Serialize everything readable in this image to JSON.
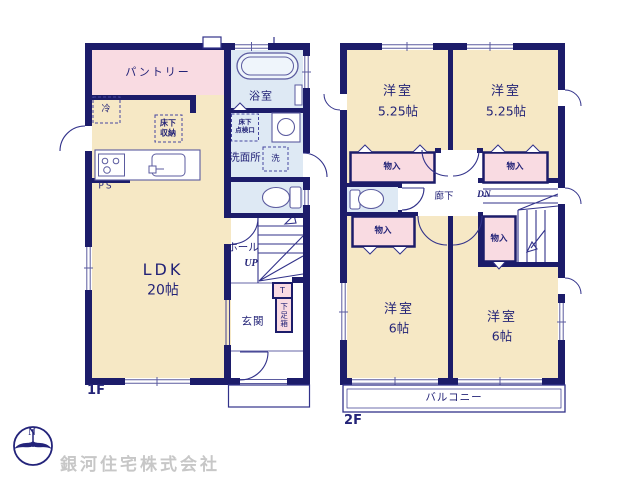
{
  "floor1": {
    "label": "1F",
    "pantry": "パントリー",
    "fridge": "冷",
    "underfloor_storage": "床下\n収納",
    "bathroom": "浴室",
    "inspection_hatch": "床下\n点検口",
    "washroom": "洗面所",
    "washer": "洗",
    "pipe_space": "PS",
    "ldk": {
      "name": "LDK",
      "size": "20帖"
    },
    "hall": "ホール",
    "up": "UP",
    "entrance": "玄関",
    "shoe_cabinet_t": "T",
    "shoe_cabinet": "下足箱"
  },
  "floor2": {
    "label": "2F",
    "rooms": [
      {
        "id": "nw",
        "name": "洋室",
        "size": "5.25帖"
      },
      {
        "id": "ne",
        "name": "洋室",
        "size": "5.25帖"
      },
      {
        "id": "sw",
        "name": "洋室",
        "size": "6帖"
      },
      {
        "id": "se",
        "name": "洋室",
        "size": "6帖"
      }
    ],
    "closet_label": "物入",
    "corridor": "廊下",
    "down": "DN",
    "balcony": "バルコニー"
  },
  "branding": {
    "company": "銀河住宅株式会社",
    "compass_north": "N"
  },
  "colors": {
    "wall": "#1c1c6a",
    "line": "#32328a",
    "room_cream": "#f6e8c5",
    "closet_pink": "#f9dbe2",
    "wet_blue": "#dee9f4",
    "text_navy": "#232377",
    "watermark_gray": "#c7c7c7"
  }
}
